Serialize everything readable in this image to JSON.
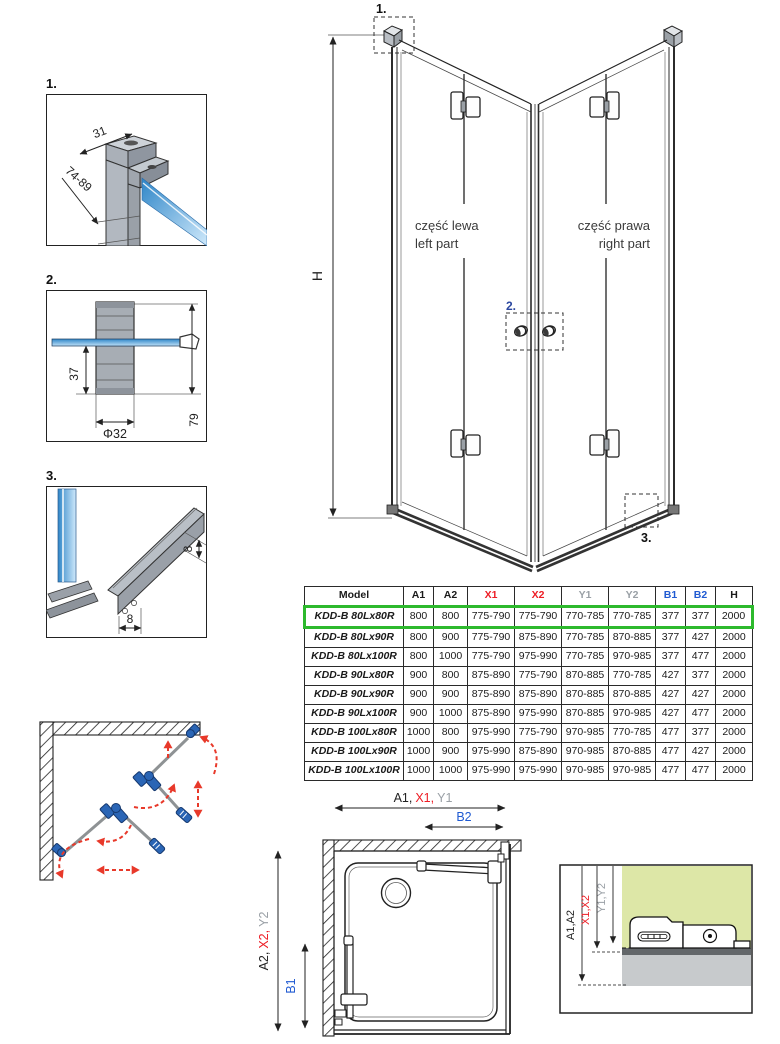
{
  "details": {
    "d1": {
      "label": "1.",
      "dim_width": "31",
      "dim_range": "74-89"
    },
    "d2": {
      "label": "2.",
      "dim_offset": "37",
      "dim_height": "79",
      "dim_diameter": "Φ32"
    },
    "d3": {
      "label": "3.",
      "dim_height": "8",
      "dim_width": "8"
    }
  },
  "main_drawing": {
    "callout_top": "1.",
    "callout_knobs": "2.",
    "callout_bottom": "3.",
    "height_label": "H",
    "left_part_pl": "część lewa",
    "left_part_en": "left part",
    "right_part_pl": "część prawa",
    "right_part_en": "right part"
  },
  "table": {
    "headers": [
      {
        "label": "Model",
        "color": "black"
      },
      {
        "label": "A1",
        "color": "black"
      },
      {
        "label": "A2",
        "color": "black"
      },
      {
        "label": "X1",
        "color": "red"
      },
      {
        "label": "X2",
        "color": "red"
      },
      {
        "label": "Y1",
        "color": "gray"
      },
      {
        "label": "Y2",
        "color": "gray"
      },
      {
        "label": "B1",
        "color": "blue"
      },
      {
        "label": "B2",
        "color": "blue"
      },
      {
        "label": "H",
        "color": "black"
      }
    ],
    "rows": [
      {
        "model": "KDD-B 80Lx80R",
        "highlighted": true,
        "values": [
          "800",
          "800",
          "775-790",
          "775-790",
          "770-785",
          "770-785",
          "377",
          "377",
          "2000"
        ]
      },
      {
        "model": "KDD-B 80Lx90R",
        "highlighted": false,
        "values": [
          "800",
          "900",
          "775-790",
          "875-890",
          "770-785",
          "870-885",
          "377",
          "427",
          "2000"
        ]
      },
      {
        "model": "KDD-B 80Lx100R",
        "highlighted": false,
        "values": [
          "800",
          "1000",
          "775-790",
          "975-990",
          "770-785",
          "970-985",
          "377",
          "477",
          "2000"
        ]
      },
      {
        "model": "KDD-B 90Lx80R",
        "highlighted": false,
        "values": [
          "900",
          "800",
          "875-890",
          "775-790",
          "870-885",
          "770-785",
          "427",
          "377",
          "2000"
        ]
      },
      {
        "model": "KDD-B 90Lx90R",
        "highlighted": false,
        "values": [
          "900",
          "900",
          "875-890",
          "875-890",
          "870-885",
          "870-885",
          "427",
          "427",
          "2000"
        ]
      },
      {
        "model": "KDD-B 90Lx100R",
        "highlighted": false,
        "values": [
          "900",
          "1000",
          "875-890",
          "975-990",
          "870-885",
          "970-985",
          "427",
          "477",
          "2000"
        ]
      },
      {
        "model": "KDD-B 100Lx80R",
        "highlighted": false,
        "values": [
          "1000",
          "800",
          "975-990",
          "775-790",
          "970-985",
          "770-785",
          "477",
          "377",
          "2000"
        ]
      },
      {
        "model": "KDD-B 100Lx90R",
        "highlighted": false,
        "values": [
          "1000",
          "900",
          "975-990",
          "875-890",
          "970-985",
          "870-885",
          "477",
          "427",
          "2000"
        ]
      },
      {
        "model": "KDD-B 100Lx100R",
        "highlighted": false,
        "values": [
          "1000",
          "1000",
          "975-990",
          "975-990",
          "970-985",
          "970-985",
          "477",
          "477",
          "2000"
        ]
      }
    ]
  },
  "top_view": {
    "dim_a1": "A1,",
    "dim_x1": "X1,",
    "dim_y1": "Y1",
    "dim_b2": "B2",
    "dim_a2": "A2,",
    "dim_x2": "X2,",
    "dim_y2": "Y2",
    "dim_b1": "B1"
  },
  "section_view": {
    "dim_a": "A1,A2",
    "dim_x": "X1,X2",
    "dim_y": "Y1,Y2"
  },
  "colors": {
    "highlight_green": "#2db92d",
    "dim_red": "#ed1c24",
    "dim_gray": "#9aa0a6",
    "dim_blue": "#1f5ad2",
    "glass_blue": "#4d9fdd",
    "hinge_blue": "#2a65b5",
    "arrow_red": "#e8392a",
    "section_green": "#dde7a7"
  }
}
